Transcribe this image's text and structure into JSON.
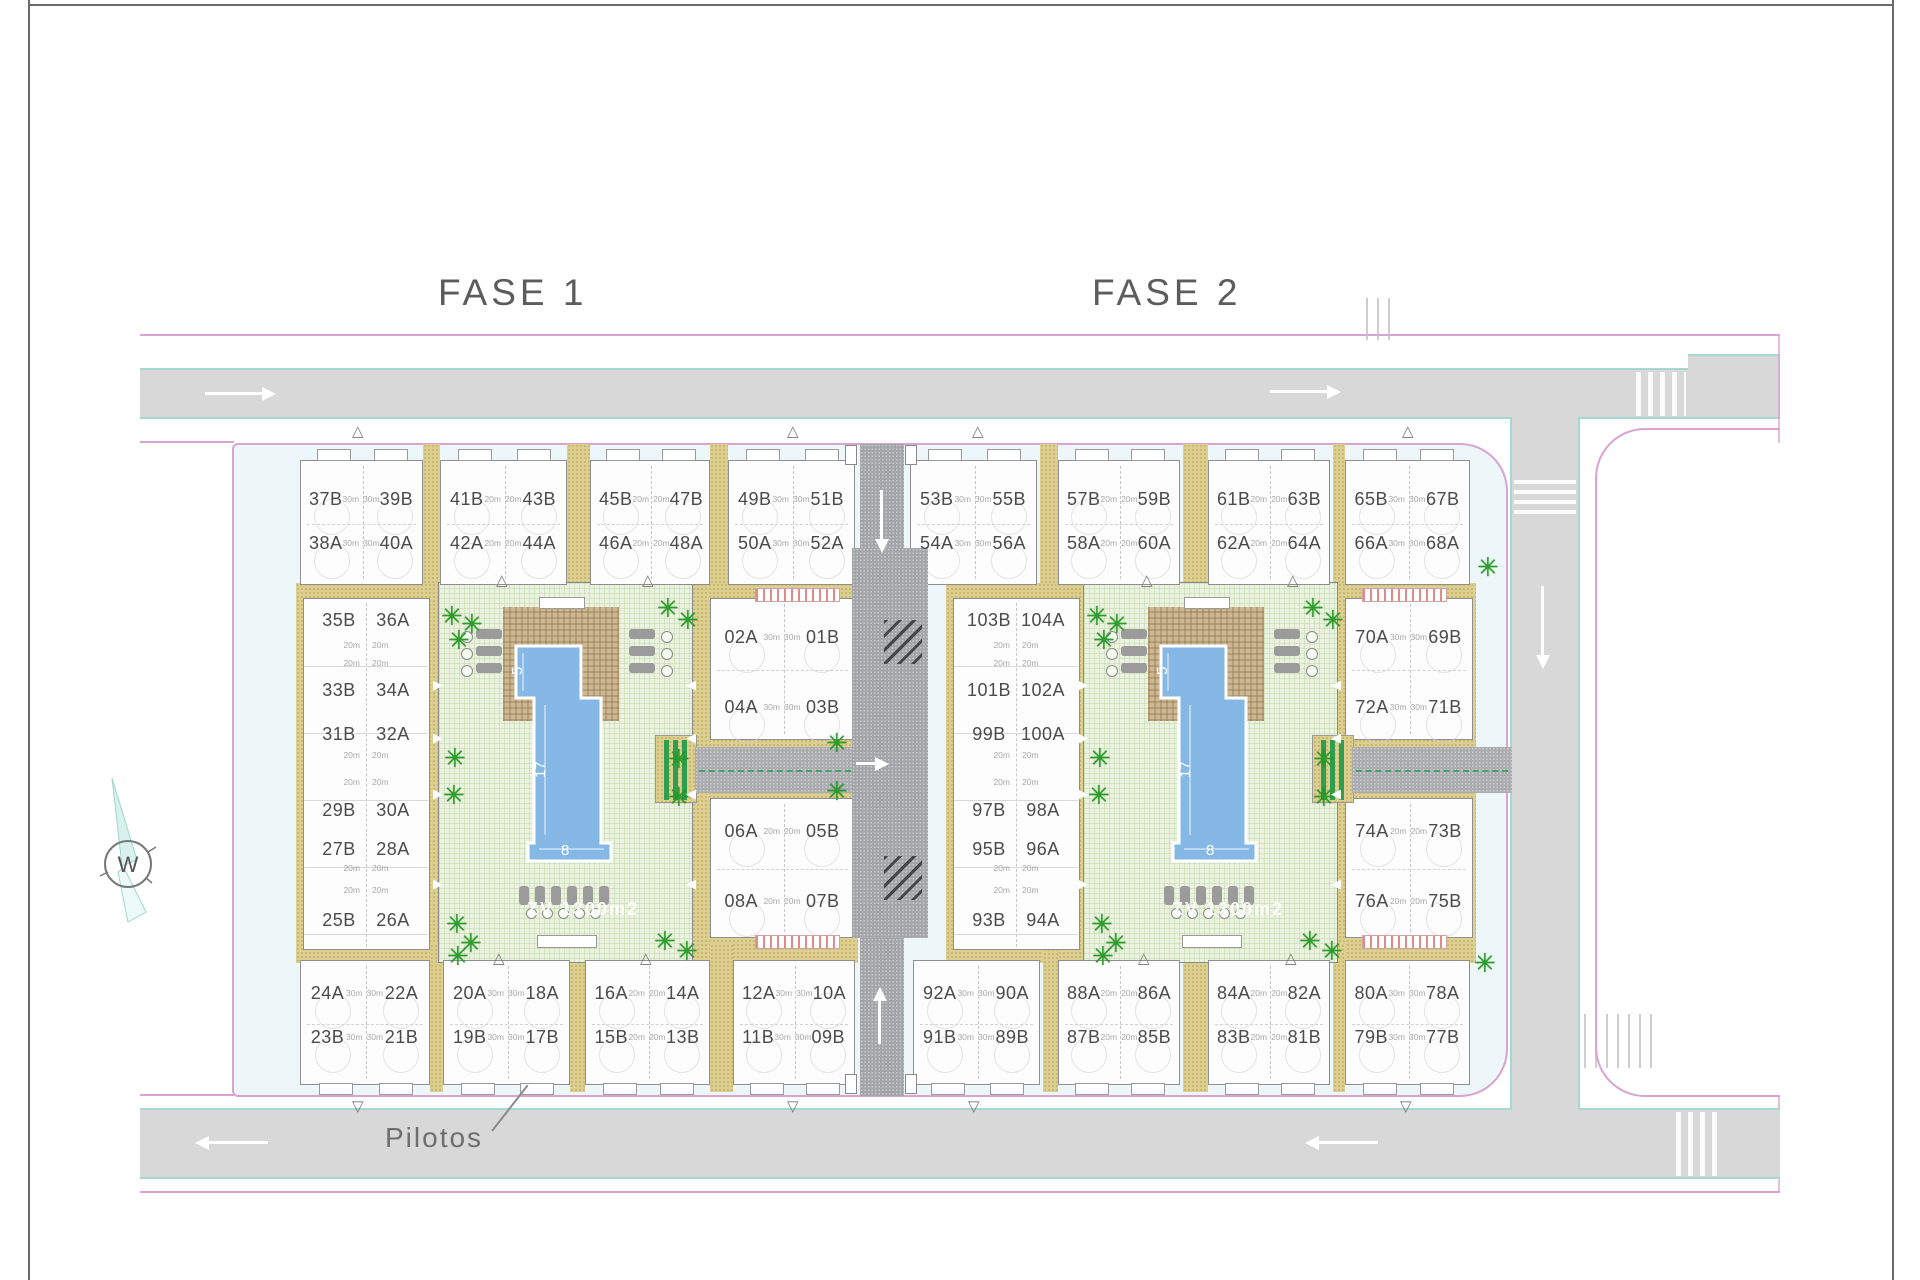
{
  "titles": {
    "fase1": "FASE 1",
    "fase2": "FASE 2"
  },
  "labels": {
    "pilotos": "Pilotos",
    "green_area": "ZV 1300m2",
    "compass": "W",
    "area20": "20m"
  },
  "pool_dims": {
    "top_width": "5",
    "length": "17",
    "bottom_width": "8"
  },
  "colors": {
    "boundary_pink": "#d9a3d3",
    "road_edge_teal": "#a5d8d1",
    "road_gray": "#d8d8d8",
    "inner_road_gray": "#a4a5a9",
    "paving_tan": "#dccf90",
    "garden_green": "#ebf2e0",
    "pool_blue": "#85b8e4",
    "palm_green": "#28a028",
    "text_gray": "#4b4b4b"
  },
  "phases": [
    {
      "name": "FASE 1",
      "top_blocks": [
        {
          "tl": "37B",
          "tr": "39B",
          "bl": "38A",
          "br": "40A",
          "area": "30m"
        },
        {
          "tl": "41B",
          "tr": "43B",
          "bl": "42A",
          "br": "44A",
          "area": "20m"
        },
        {
          "tl": "45B",
          "tr": "47B",
          "bl": "46A",
          "br": "48A",
          "area": "20m"
        },
        {
          "tl": "49B",
          "tr": "51B",
          "bl": "50A",
          "br": "52A",
          "area": "30m"
        }
      ],
      "strip_rows": [
        {
          "l": "35B",
          "r": "36A"
        },
        {
          "l": "33B",
          "r": "34A"
        },
        {
          "l": "31B",
          "r": "32A"
        },
        {
          "l": "29B",
          "r": "30A"
        },
        {
          "l": "27B",
          "r": "28A"
        },
        {
          "l": "25B",
          "r": "26A"
        }
      ],
      "side_blocks": [
        {
          "tl": "02A",
          "tr": "01B",
          "bl": "04A",
          "br": "03B",
          "area": "30m"
        },
        {
          "tl": "06A",
          "tr": "05B",
          "bl": "08A",
          "br": "07B",
          "area": "20m"
        }
      ],
      "bottom_blocks": [
        {
          "tl": "24A",
          "tr": "22A",
          "bl": "23B",
          "br": "21B",
          "area": "30m"
        },
        {
          "tl": "20A",
          "tr": "18A",
          "bl": "19B",
          "br": "17B",
          "area": "30m"
        },
        {
          "tl": "16A",
          "tr": "14A",
          "bl": "15B",
          "br": "13B",
          "area": "20m"
        },
        {
          "tl": "12A",
          "tr": "10A",
          "bl": "11B",
          "br": "09B",
          "area": "30m"
        }
      ]
    },
    {
      "name": "FASE 2",
      "top_blocks": [
        {
          "tl": "53B",
          "tr": "55B",
          "bl": "54A",
          "br": "56A",
          "area": "30m"
        },
        {
          "tl": "57B",
          "tr": "59B",
          "bl": "58A",
          "br": "60A",
          "area": "20m"
        },
        {
          "tl": "61B",
          "tr": "63B",
          "bl": "62A",
          "br": "64A",
          "area": "20m"
        },
        {
          "tl": "65B",
          "tr": "67B",
          "bl": "66A",
          "br": "68A",
          "area": "30m"
        }
      ],
      "strip_rows": [
        {
          "l": "103B",
          "r": "104A"
        },
        {
          "l": "101B",
          "r": "102A"
        },
        {
          "l": "99B",
          "r": "100A"
        },
        {
          "l": "97B",
          "r": "98A"
        },
        {
          "l": "95B",
          "r": "96A"
        },
        {
          "l": "93B",
          "r": "94A"
        }
      ],
      "side_blocks": [
        {
          "tl": "70A",
          "tr": "69B",
          "bl": "72A",
          "br": "71B",
          "area": "30m"
        },
        {
          "tl": "74A",
          "tr": "73B",
          "bl": "76A",
          "br": "75B",
          "area": "20m"
        }
      ],
      "bottom_blocks": [
        {
          "tl": "92A",
          "tr": "90A",
          "bl": "91B",
          "br": "89B",
          "area": "30m"
        },
        {
          "tl": "88A",
          "tr": "86A",
          "bl": "87B",
          "br": "85B",
          "area": "20m"
        },
        {
          "tl": "84A",
          "tr": "82A",
          "bl": "83B",
          "br": "81B",
          "area": "20m"
        },
        {
          "tl": "80A",
          "tr": "78A",
          "bl": "79B",
          "br": "77B",
          "area": "30m"
        }
      ]
    }
  ]
}
